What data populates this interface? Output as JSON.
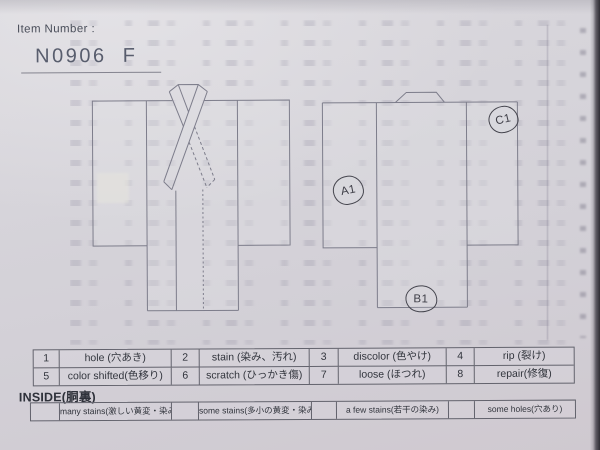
{
  "colors": {
    "paper": "#d5d3d9",
    "ink": "#31343c",
    "diagram_line": "#7d7d8b",
    "marker_ink": "#3e3e47",
    "photo_edge": "#2e2c33"
  },
  "header": {
    "item_number_label": "Item Number :",
    "item_number_value": "N0906  F"
  },
  "diagram": {
    "front_view": "kimono-front",
    "back_view": "kimono-back",
    "markers": [
      {
        "label": "A1"
      },
      {
        "label": "B1"
      },
      {
        "label": "C1"
      }
    ]
  },
  "defect_table": {
    "rows": [
      [
        {
          "num": "1",
          "label": "hole (穴あき)"
        },
        {
          "num": "2",
          "label": "stain (染み、汚れ)"
        },
        {
          "num": "3",
          "label": "discolor (色やけ)"
        },
        {
          "num": "4",
          "label": "rip (裂け)"
        }
      ],
      [
        {
          "num": "5",
          "label": "color shifted(色移り)"
        },
        {
          "num": "6",
          "label": "scratch (ひっかき傷)"
        },
        {
          "num": "7",
          "label": "loose (ほつれ)"
        },
        {
          "num": "8",
          "label": "repair(修復)"
        }
      ]
    ]
  },
  "inside_section": {
    "heading": "INSIDE(胴裏)",
    "options": [
      {
        "label": "many stains(激しい黄変・染み)"
      },
      {
        "label": "some stains(多小の黄変・染み)"
      },
      {
        "label": "a few stains(若干の染み)"
      },
      {
        "label": "some holes(穴あり)"
      }
    ]
  }
}
